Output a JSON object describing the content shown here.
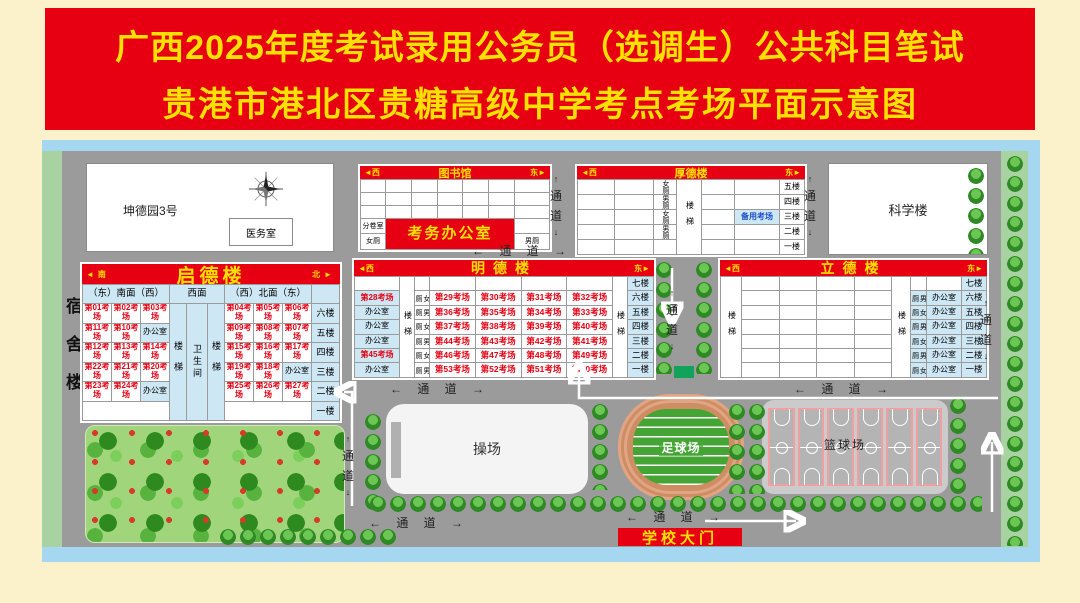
{
  "title": {
    "line1": "广西2025年度考试录用公务员（选调生）公共科目笔试",
    "line2": "贵港市港北区贵糖高级中学考点考场平面示意图"
  },
  "dorm_label": "宿舍楼",
  "kundeyuan": {
    "name": "坤德园3号",
    "clinic": "医务室"
  },
  "science": {
    "name": "科学楼"
  },
  "library": {
    "name": "图书馆",
    "west": "◄西",
    "east": "东►",
    "paper_room": "分卷室",
    "women": "女厕",
    "men": "男厕",
    "exam_office": "考务办公室"
  },
  "houde": {
    "name": "厚德楼",
    "west": "◄西",
    "east": "东►",
    "toilets": [
      "女厕",
      "男厕",
      "女厕",
      "男厕",
      ""
    ],
    "stairs": "楼梯",
    "spare": "备用考场",
    "floors": [
      "五楼",
      "四楼",
      "三楼",
      "二楼",
      "一楼"
    ]
  },
  "qide": {
    "name": "启德楼",
    "south": "◄南",
    "north": "北►",
    "sub_south": "（东）南面（西）",
    "sub_west": "西面",
    "sub_north": "（西）北面（东）",
    "stairs": "楼梯",
    "restroom": "卫生间",
    "floors": [
      "六楼",
      "五楼",
      "四楼",
      "三楼",
      "二楼",
      "一楼"
    ],
    "south_rows": [
      [
        "第01考场",
        "第02考场",
        "第03考场"
      ],
      [
        "第11考场",
        "第10考场",
        "办公室"
      ],
      [
        "第12考场",
        "第13考场",
        "第14考场"
      ],
      [
        "第22考场",
        "第21考场",
        "第20考场"
      ],
      [
        "第23考场",
        "第24考场",
        "办公室"
      ]
    ],
    "north_rows": [
      [
        "第04考场",
        "第05考场",
        "第06考场"
      ],
      [
        "第09考场",
        "第08考场",
        "第07考场"
      ],
      [
        "第15考场",
        "第16考场",
        "第17考场"
      ],
      [
        "第19考场",
        "第18考场",
        "办公室"
      ],
      [
        "第25考场",
        "第26考场",
        "第27考场"
      ]
    ]
  },
  "mingde": {
    "name": "明德楼",
    "west": "◄西",
    "east": "东►",
    "stairs": "楼梯",
    "floors": [
      "七楼",
      "六楼",
      "五楼",
      "四楼",
      "三楼",
      "二楼",
      "一楼"
    ],
    "left_col": [
      "",
      "第28考场",
      "办公室",
      "办公室",
      "办公室",
      "第45考场",
      "办公室"
    ],
    "toilet_col": [
      "",
      "女厕",
      "男厕",
      "女厕",
      "男厕",
      "女厕",
      "男厕"
    ],
    "rooms": [
      [
        "",
        "",
        "",
        ""
      ],
      [
        "第29考场",
        "第30考场",
        "第31考场",
        "第32考场"
      ],
      [
        "第36考场",
        "第35考场",
        "第34考场",
        "第33考场"
      ],
      [
        "第37考场",
        "第38考场",
        "第39考场",
        "第40考场"
      ],
      [
        "第44考场",
        "第43考场",
        "第42考场",
        "第41考场"
      ],
      [
        "第46考场",
        "第47考场",
        "第48考场",
        "第49考场"
      ],
      [
        "第53考场",
        "第52考场",
        "第51考场",
        "第50考场"
      ]
    ]
  },
  "lide": {
    "name": "立德楼",
    "west": "◄西",
    "east": "东►",
    "stairs": "楼梯",
    "floors": [
      "七楼",
      "六楼",
      "五楼",
      "四楼",
      "三楼",
      "二楼",
      "一楼"
    ],
    "toilet_col": [
      "",
      "男厕",
      "女厕",
      "男厕",
      "女厕",
      "男厕",
      "女厕"
    ],
    "office_col": [
      "",
      "办公室",
      "办公室",
      "办公室",
      "办公室",
      "办公室",
      "办公室"
    ]
  },
  "grounds": {
    "playground": "操场",
    "football": "足球场",
    "basketball": "篮球场",
    "gate": "学校大门"
  },
  "passages": {
    "h": "←  通  道  →",
    "up": "↑",
    "label": "通道",
    "down": "↓"
  },
  "colors": {
    "title_bg": "#e60012",
    "title_text": "#ffe100",
    "map_bg": "#9b9b9b",
    "frame_blue": "#a5d8f0",
    "frame_green": "#a9d2a2",
    "cell_blue": "#cde7f5",
    "exam_red": "#e60012",
    "spare_blue": "#1f4fc8",
    "track": "#cf8d63",
    "field": "#44a534",
    "court_border": "#f0a0a0"
  }
}
